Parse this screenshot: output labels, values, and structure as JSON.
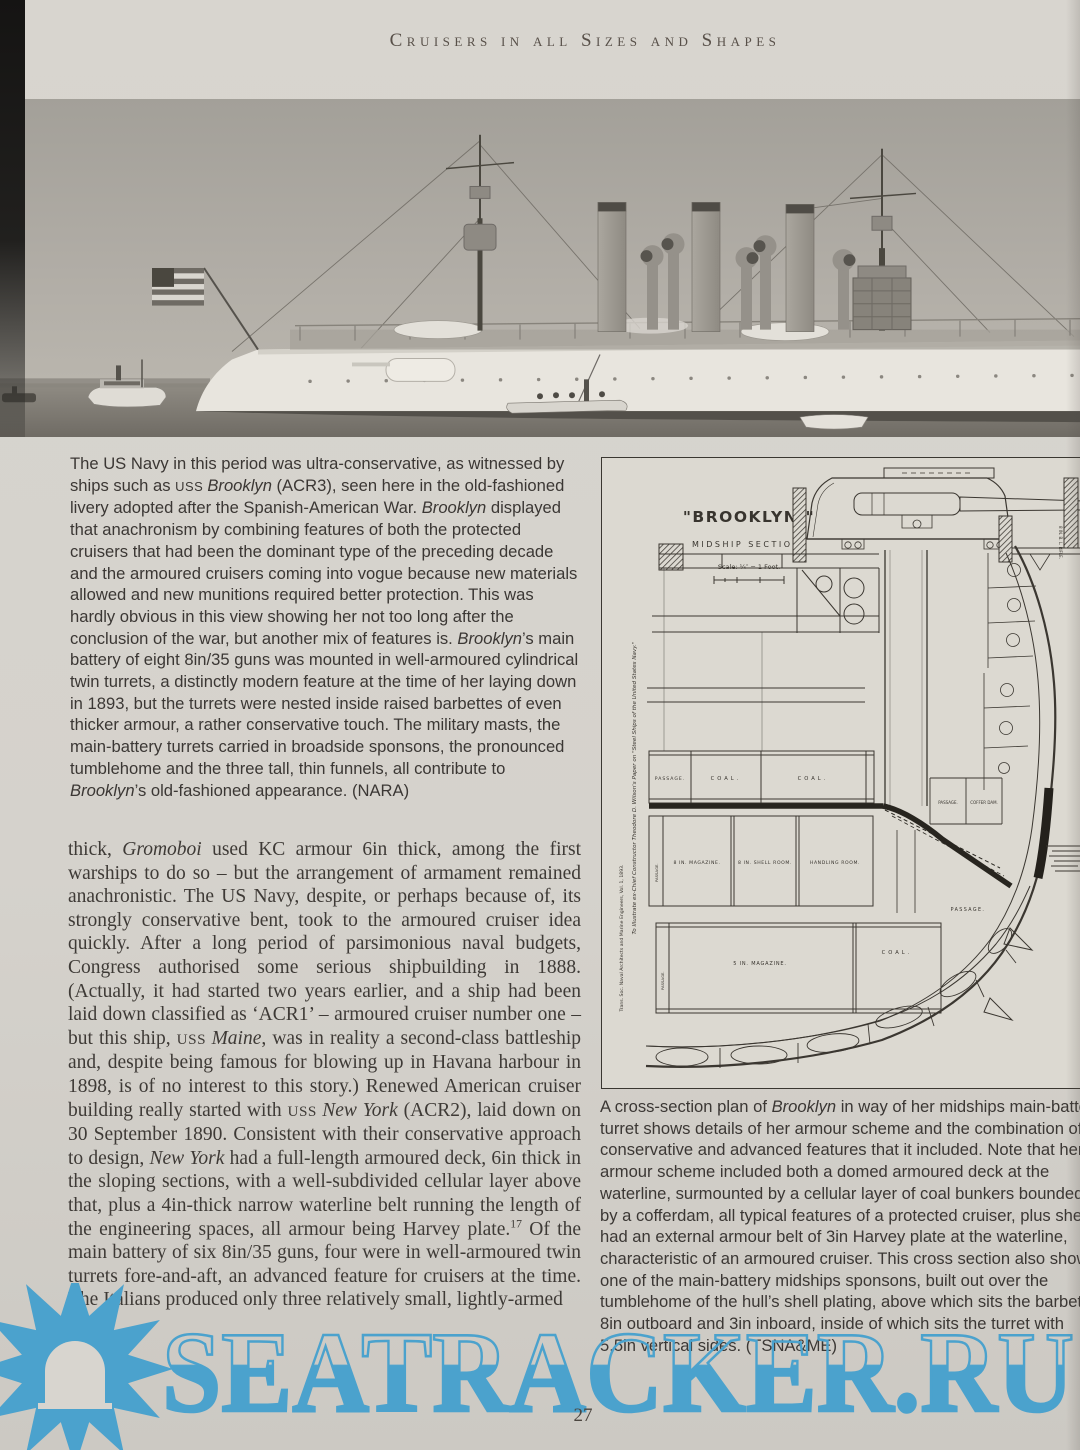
{
  "header": {
    "title": "Cruisers in all Sizes and Shapes"
  },
  "page_number": "27",
  "colors": {
    "watermark_blue": "#4ba2cd",
    "page_background": "#d5d2cc",
    "diagram_ink": "#3b3731"
  },
  "watermark": {
    "text": "SEATRACKER.RU"
  },
  "photo_caption": {
    "segments": [
      {
        "t": "The US Navy in this period was ultra-conservative, as witnessed by ships such as "
      },
      {
        "t": "USS ",
        "s": "sc"
      },
      {
        "t": "Brooklyn",
        "s": "i"
      },
      {
        "t": " (ACR3), seen here in the old-fashioned livery adopted after the Spanish-American War. "
      },
      {
        "t": "Brooklyn",
        "s": "i"
      },
      {
        "t": " displayed that anachronism by combining features of both the protected cruisers that had been the dominant type of the preceding decade and the armoured cruisers coming into vogue because new materials allowed and new munitions required better protection. This was hardly obvious in this view showing her not too long after the conclusion of the war, but another mix of features is. "
      },
      {
        "t": "Brooklyn",
        "s": "i"
      },
      {
        "t": "’s main battery of eight 8in/35 guns was mounted in well-armoured cylindrical twin turrets, a distinctly modern feature at the time of her laying down in 1893, but the turrets were nested inside raised barbettes of even thicker armour, a rather conservative touch. The military masts, the main-battery turrets carried in broadside sponsons, the pronounced tumblehome and the three tall, thin funnels, all contribute to "
      },
      {
        "t": "Brooklyn",
        "s": "i"
      },
      {
        "t": "’s old-fashioned appearance. (NARA)"
      }
    ]
  },
  "body_text": {
    "segments": [
      {
        "t": "thick, "
      },
      {
        "t": "Gromoboi",
        "s": "i"
      },
      {
        "t": " used KC armour 6in thick, among the first warships to do so – but the arrangement of armament remained anachronistic. The US Navy, despite, or perhaps because of, its strongly conservative bent, took to the armoured cruiser idea quickly. After a long period of parsimonious naval budgets, Congress authorised some serious shipbuilding in 1888. (Actually, it had started two years earlier, and a ship had been laid down classified as ‘ACR1’ – armoured cruiser number one – but this ship, "
      },
      {
        "t": "USS ",
        "s": "sc"
      },
      {
        "t": "Maine",
        "s": "i"
      },
      {
        "t": ", was in reality a second-class battleship and, despite being famous for blowing up in Havana harbour in 1898, is of no interest to this story.) Renewed American cruiser building really started with "
      },
      {
        "t": "USS ",
        "s": "sc"
      },
      {
        "t": "New York",
        "s": "i"
      },
      {
        "t": " (ACR2), laid down on 30 September 1890. Consistent with their conservative approach to design, "
      },
      {
        "t": "New York",
        "s": "i"
      },
      {
        "t": " had a full-length armoured deck, 6in thick in the sloping sections, with a well-subdivided cellular layer above that, plus a 4in-thick narrow waterline belt running the length of the engineering spaces, all armour being Harvey plate."
      },
      {
        "t": "17",
        "s": "sup"
      },
      {
        "t": " Of the main battery of six 8in/35 guns, four were in well-armoured twin turrets fore-and-aft, an advanced feature for cruisers at the time. The Italians produced only three relatively small, lightly-armed"
      }
    ]
  },
  "diagram_caption": {
    "segments": [
      {
        "t": "A cross-section plan of "
      },
      {
        "t": "Brooklyn",
        "s": "i"
      },
      {
        "t": " in way of her midships main-battery turret shows details of her armour scheme and the combination of conservative and advanced features that it included. Note that her armour scheme included both a domed armoured deck at the waterline, surmounted by a cellular layer of coal bunkers bounded by a cofferdam, all typical features of a protected cruiser, plus she had an external armour belt of 3in Harvey plate at the waterline, characteristic of an armoured cruiser. This cross section also shows one of the main-battery midships sponsons, built out over the tumblehome of the hull’s shell plating, above which sits the barbette, 8in outboard and 3in inboard, inside of which sits the turret with 5.5in vertical sides. (TSNA&ME)"
      }
    ]
  },
  "diagram": {
    "title": "\"BROOKLYN.\"",
    "subtitle": "MIDSHIP SECTION.",
    "scale_label": "Scale: ¼″ = 1 Foot.",
    "labels": {
      "passage_coal": "PASSAGE.",
      "coal_1": "COAL.",
      "coal_2": "COAL.",
      "magazine_8in": "8 IN. MAGAZINE.",
      "shell_room_8in": "8 IN. SHELL ROOM.",
      "handling_room": "HANDLING ROOM.",
      "passage_magazine": "PASSAGE.",
      "passage_hull": "PASSAGE.",
      "passage_side": "PASSAGE.",
      "coffer_dam": "COFFER DAM.",
      "magazine_5in": "5 IN. MAGAZINE.",
      "coal_3": "COAL.",
      "passage_bottom": "PASSAGE."
    },
    "side_note_1": "To Illustrate ex-Chief Constructor Theodore D. Wilson's Paper on \"Steel Ships of the United States Navy.\"",
    "side_note_2": "Trans. Soc. Naval Architects and Marine Engineers, Vol. 1, 1893.",
    "gun_note": "8 IN. B. L. RIFLE."
  }
}
